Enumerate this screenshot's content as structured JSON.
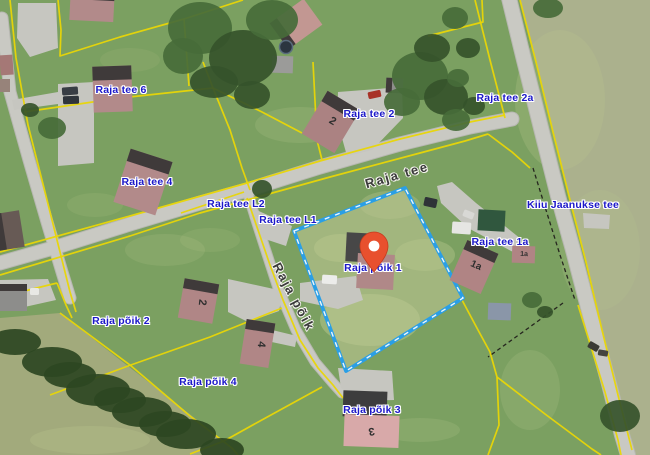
{
  "map": {
    "width": 650,
    "height": 455,
    "palette": {
      "grass": "#7ba061",
      "grass_light": "#bac78f",
      "field_right": "#abb18d",
      "field_bottom_left": "#a2aa7c",
      "selected_parcel_fill": "#a2b67e",
      "road": "#c9c9c3",
      "road_casing": "#b7b7b1",
      "driveway": "#c6c6c0",
      "parcel_line": "#e9d606",
      "boundary_dashed": "#26261f",
      "selected_parcel_stroke": "#2a9fe6",
      "selected_parcel_dash": "#ffffff",
      "roof_dark": "#3f3a3a",
      "label_blue": "#1c18c9",
      "street_gray": "#3a3a3a",
      "marker_color": "#e8502e",
      "tree": "#466b39",
      "tree_dark": "#35522b",
      "hedge": "#2c4722"
    },
    "regions": [
      {
        "name": "field-right",
        "points": "520,0 536,62 553,132 570,200 586,262 602,330 618,395 632,450 634,455 650,455 650,0",
        "fill": "#abb18d"
      },
      {
        "name": "field-bottom-left",
        "points": "0,318 60,313 233,448 238,455 0,455",
        "fill": "#a2aa7c"
      },
      {
        "name": "selected-parcel-fill",
        "points": "294,231 405,188 463,298 346,371",
        "fill": "#a2b67e"
      }
    ],
    "patches": [
      [
        370,
        320,
        50,
        26,
        0.5
      ],
      [
        340,
        248,
        26,
        14,
        0.45
      ],
      [
        425,
        255,
        30,
        16,
        0.4
      ],
      [
        390,
        205,
        30,
        14,
        0.35
      ],
      [
        300,
        125,
        45,
        18,
        0.2
      ],
      [
        165,
        250,
        40,
        16,
        0.18
      ],
      [
        95,
        205,
        28,
        12,
        0.15
      ],
      [
        210,
        240,
        30,
        12,
        0.15
      ],
      [
        560,
        100,
        45,
        70,
        0.25
      ],
      [
        600,
        250,
        40,
        60,
        0.2
      ],
      [
        90,
        440,
        60,
        14,
        0.3
      ],
      [
        420,
        430,
        40,
        12,
        0.2
      ],
      [
        130,
        60,
        30,
        12,
        0.12
      ],
      [
        530,
        390,
        30,
        40,
        0.2
      ]
    ],
    "roads": [
      {
        "name": "road-raja-tee",
        "points": "0,263 60,246 130,224 200,203 247,190 320,167 400,144 470,127 512,119",
        "width": 13
      },
      {
        "name": "road-kiiu-jaanukse-tee",
        "points": "508,-6 524,60 541,128 558,196 573,250 590,315 608,380 622,435 628,455",
        "width": 14
      },
      {
        "name": "road-raja-poik",
        "points": "247,191 256,220 265,248 278,288 296,330 315,362 332,382 342,393",
        "width": 9
      },
      {
        "name": "road-left",
        "points": "2,18 10,92 29,160 47,222 62,272 70,298",
        "width": 11
      }
    ],
    "driveways": [
      "18,3 56,3 58,48 30,57 17,38",
      "58,84 94,82 94,163 58,166",
      "12,100 58,92 58,104 14,110",
      "338,92 402,87 403,118 372,150 347,156 337,120",
      "252,208 292,226 286,246 262,238 250,218",
      "300,283 356,276 363,300 338,309 300,301",
      "437,186 452,182 476,203 521,239 513,252 468,228 441,203",
      "583,213 610,215 609,229 584,228",
      "338,368 392,371 394,400 362,401 341,388",
      "228,279 283,291 279,311 248,322 228,312",
      "0,280 48,279 56,300 20,308 0,302",
      "268,329 297,336 295,347 267,341"
    ],
    "parcel_lines": [
      "10,0 16,58 28,125 45,192 60,252 70,292 76,312",
      "58,0 61,30 60,56 120,37 184,19 243,0",
      "184,19 189,86",
      "24,112 120,98 213,88 262,112 302,133",
      "213,88 203,62",
      "313,62 317,140 322,160",
      "428,36 483,22 482,0",
      "0,252 130,216 247,183 320,161 400,139 470,122 505,115",
      "0,275 130,236 200,213 247,200 330,177 420,153 465,141 488,134",
      "488,134 512,152 530,168",
      "475,0 490,60 505,118",
      "578,305 592,350 605,392 618,440 621,455",
      "520,0 536,62 553,132 570,200 586,262 602,330 618,395 632,450",
      "213,88 230,130 242,168 250,190",
      "181,213 244,192",
      "247,198 258,230 270,265 283,300 300,340 318,368 333,385 343,398",
      "0,297 57,283",
      "57,283 66,305 72,318",
      "60,313 130,365 190,416 232,448 238,455",
      "322,387 260,421 224,441 190,454",
      "50,395 128,366 210,337 282,308",
      "462,300 478,330 490,352 497,377",
      "497,377 499,425 488,455",
      "497,377 545,414 592,449 601,455"
    ],
    "dashed_lines": [
      "533,168 546,210 560,255 575,300",
      "563,303 527,329 488,357"
    ],
    "selected_parcel": {
      "points": "294,231 405,188 463,298 346,371"
    },
    "trees": [
      [
        200,
        28,
        32,
        26
      ],
      [
        243,
        58,
        34,
        28
      ],
      [
        272,
        20,
        26,
        20
      ],
      [
        214,
        82,
        24,
        16
      ],
      [
        183,
        56,
        20,
        18
      ],
      [
        252,
        95,
        18,
        14
      ],
      [
        420,
        76,
        28,
        24
      ],
      [
        446,
        97,
        22,
        18
      ],
      [
        402,
        102,
        18,
        14
      ],
      [
        432,
        48,
        18,
        14
      ],
      [
        456,
        120,
        14,
        11
      ],
      [
        262,
        189,
        10,
        9
      ],
      [
        455,
        18,
        13,
        11
      ],
      [
        468,
        48,
        12,
        10
      ],
      [
        458,
        78,
        11,
        9
      ],
      [
        474,
        106,
        11,
        9
      ],
      [
        548,
        8,
        15,
        10
      ],
      [
        620,
        416,
        20,
        16
      ],
      [
        52,
        128,
        14,
        11
      ],
      [
        30,
        110,
        9,
        7
      ],
      [
        532,
        300,
        10,
        8
      ],
      [
        545,
        312,
        8,
        6
      ],
      [
        15,
        342,
        26,
        13,
        "#2c4722"
      ],
      [
        52,
        362,
        30,
        15,
        "#2c4722"
      ],
      [
        98,
        390,
        32,
        16,
        "#2c4722"
      ],
      [
        142,
        412,
        30,
        15,
        "#2c4722"
      ],
      [
        186,
        434,
        30,
        15,
        "#2c4722"
      ],
      [
        222,
        450,
        22,
        12,
        "#2c4722"
      ],
      [
        120,
        400,
        26,
        13,
        "#2c4722"
      ],
      [
        70,
        375,
        26,
        13,
        "#2c4722"
      ],
      [
        165,
        424,
        26,
        13,
        "#2c4722"
      ]
    ],
    "houses": [
      [
        70,
        -9,
        44,
        30,
        3,
        "#b28a8a",
        "t",
        9
      ],
      [
        93,
        66,
        39,
        46,
        -2,
        "#b28a8a",
        "t",
        14
      ],
      [
        121,
        154,
        44,
        56,
        18,
        "#b28a8a",
        "t",
        13
      ],
      [
        312,
        97,
        38,
        50,
        31,
        "#ab8282",
        "t",
        12
      ],
      [
        386,
        78,
        17,
        15,
        3,
        "#8f8f8d",
        "l",
        6
      ],
      [
        275,
        8,
        42,
        32,
        -36,
        "#c29792",
        "l",
        9
      ],
      [
        272,
        56,
        21,
        17,
        2,
        "#9b9b99",
        "",
        0
      ],
      [
        346,
        233,
        31,
        29,
        3,
        "#474747",
        "",
        0
      ],
      [
        357,
        254,
        37,
        35,
        3,
        "#b08888",
        "",
        0
      ],
      [
        457,
        245,
        34,
        44,
        24,
        "#b08484",
        "t",
        10
      ],
      [
        512,
        246,
        23,
        17,
        2,
        "#b08484",
        "",
        0
      ],
      [
        478,
        210,
        27,
        21,
        3,
        "#30573e",
        "",
        0
      ],
      [
        181,
        281,
        35,
        40,
        10,
        "#b08686",
        "t",
        10
      ],
      [
        243,
        321,
        29,
        45,
        9,
        "#b08686",
        "t",
        10
      ],
      [
        343,
        391,
        44,
        26,
        2,
        "#3d3d3d",
        "",
        0
      ],
      [
        344,
        415,
        55,
        32,
        2,
        "#d8a9a9",
        "",
        0
      ],
      [
        0,
        284,
        27,
        27,
        0,
        "#8d8d8b",
        "t",
        7
      ],
      [
        -4,
        212,
        26,
        37,
        -9,
        "#675a55",
        "l",
        8
      ],
      [
        0,
        55,
        13,
        20,
        -4,
        "#a57876",
        "",
        0
      ],
      [
        0,
        79,
        10,
        13,
        0,
        "#97837a",
        "",
        0
      ],
      [
        488,
        303,
        23,
        17,
        2,
        "#8a96a8",
        "",
        0
      ]
    ],
    "house_numbers": [
      {
        "text": "2",
        "x": 331,
        "y": 124,
        "rot": 31,
        "size": 11
      },
      {
        "text": "1a",
        "x": 475,
        "y": 268,
        "rot": 24,
        "size": 10
      },
      {
        "text": "1a",
        "x": 524,
        "y": 256,
        "rot": 2,
        "size": 7
      },
      {
        "text": "2",
        "x": 199,
        "y": 302,
        "rot": 96,
        "size": 11
      },
      {
        "text": "4",
        "x": 258,
        "y": 344,
        "rot": 96,
        "size": 11
      },
      {
        "text": "3",
        "x": 371,
        "y": 428,
        "rot": 170,
        "size": 11
      }
    ],
    "vehicles": [
      [
        62,
        87,
        16,
        8,
        -4,
        "#383d44"
      ],
      [
        63,
        96,
        16,
        8,
        -2,
        "#2f343b"
      ],
      [
        368,
        91,
        13,
        7,
        -12,
        "#a83227"
      ],
      [
        322,
        275,
        15,
        9,
        4,
        "#ececea"
      ],
      [
        452,
        222,
        19,
        12,
        4,
        "#e6e6e3"
      ],
      [
        424,
        198,
        13,
        9,
        12,
        "#2e3237"
      ],
      [
        463,
        211,
        11,
        7,
        22,
        "#d8d8d5"
      ],
      [
        588,
        343,
        11,
        7,
        30,
        "#3a3a35"
      ],
      [
        598,
        350,
        10,
        6,
        10,
        "#44443e"
      ],
      [
        30,
        288,
        9,
        7,
        0,
        "#e8e8e4"
      ]
    ],
    "trampoline": {
      "cx": 286,
      "cy": 47,
      "r": 6.5,
      "fill": "#2b3540",
      "ring": "#5a6c7e"
    },
    "address_labels": [
      {
        "text": "Raja tee 6",
        "x": 121,
        "y": 90
      },
      {
        "text": "Raja tee 4",
        "x": 147,
        "y": 182
      },
      {
        "text": "Raja tee 2",
        "x": 369,
        "y": 114
      },
      {
        "text": "Raja tee 2a",
        "x": 505,
        "y": 98
      },
      {
        "text": "Raja tee L2",
        "x": 236,
        "y": 204
      },
      {
        "text": "Raja tee L1",
        "x": 288,
        "y": 220
      },
      {
        "text": "Kiiu Jaanukse tee",
        "x": 573,
        "y": 205
      },
      {
        "text": "Raja tee 1a",
        "x": 500,
        "y": 242
      },
      {
        "text": "Raja põik 1",
        "x": 373,
        "y": 268
      },
      {
        "text": "Raja põik 2",
        "x": 121,
        "y": 321
      },
      {
        "text": "Raja põik 4",
        "x": 208,
        "y": 382
      },
      {
        "text": "Raja põik 3",
        "x": 372,
        "y": 410
      }
    ],
    "street_labels": [
      {
        "text": "Raja tee",
        "x": 397,
        "y": 175,
        "rot": -16
      },
      {
        "text": "Raja põik",
        "x": 294,
        "y": 297,
        "rot": 62
      }
    ],
    "marker": {
      "x": 374,
      "y": 272,
      "color": "#e8502e"
    }
  }
}
